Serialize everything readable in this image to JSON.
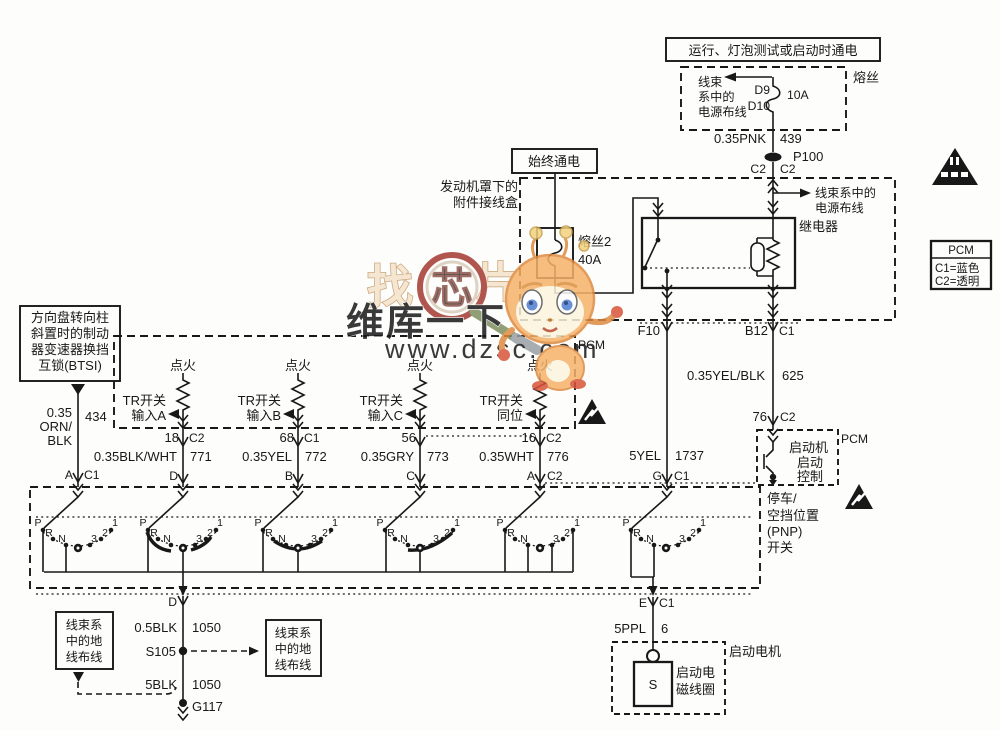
{
  "watermark": {
    "char1": "找",
    "char2": "芯",
    "char3": "片",
    "tagline": "维库一下",
    "url": "www.dzsc.com"
  },
  "top_power": {
    "title": "运行、灯泡测试或启动时通电",
    "fuse_name": "熔丝",
    "harness_l1": "线束",
    "harness_l2": "系中的",
    "harness_l3": "电源布线",
    "term_top": "D9",
    "term_bottom": "D10",
    "rating": "10A",
    "wire": "0.35PNK",
    "circuit": "439",
    "splice": "P100",
    "conn_left": "C2",
    "conn_right": "C2"
  },
  "junction_box": {
    "always_on": "始终通电",
    "name_l1": "发动机罩下的",
    "name_l2": "附件接线盒",
    "fuse2_name": "熔丝2",
    "fuse2_rating": "40A",
    "harness_l1": "线束系中的",
    "harness_l2": "电源布线",
    "relay": "继电器",
    "out_left": "F10",
    "out_right": "B12",
    "out_right_conn": "C1"
  },
  "start_control": {
    "wire": "0.35YEL/BLK",
    "circuit": "625",
    "term": "76",
    "conn": "C2",
    "pcm": "PCM",
    "l1": "启动机",
    "l2": "启动",
    "l3": "控制"
  },
  "crank_wire": {
    "wire": "5YEL",
    "circuit": "1737",
    "term": "G",
    "conn": "C1"
  },
  "btsi": {
    "l1": "方向盘转向柱",
    "l2": "斜置时的制动",
    "l3": "器变速器换挡",
    "l4": "互锁(BTSI)",
    "wire_l1": "0.35",
    "wire_l2": "ORN/",
    "wire_l3": "BLK",
    "circuit": "434",
    "term": "A",
    "conn": "C1"
  },
  "tr_box": {
    "pcm": "PCM",
    "columns": [
      {
        "ign": "点火",
        "label1": "TR开关",
        "label2": "输入A",
        "pin": "18",
        "pin_conn": "C2",
        "wire": "0.35BLK/WHT",
        "circuit": "771",
        "term": "D",
        "term_conn": ""
      },
      {
        "ign": "点火",
        "label1": "TR开关",
        "label2": "输入B",
        "pin": "68",
        "pin_conn": "C1",
        "wire": "0.35YEL",
        "circuit": "772",
        "term": "B",
        "term_conn": ""
      },
      {
        "ign": "点火",
        "label1": "TR开关",
        "label2": "输入C",
        "pin": "56",
        "pin_conn": "",
        "wire": "0.35GRY",
        "circuit": "773",
        "term": "C",
        "term_conn": ""
      },
      {
        "ign": "点火",
        "label1": "TR开关",
        "label2": "同位",
        "pin": "16",
        "pin_conn": "C2",
        "wire": "0.35WHT",
        "circuit": "776",
        "term": "A",
        "term_conn": "C2"
      }
    ]
  },
  "pnp_switch": {
    "positions": [
      "P",
      "R",
      "N",
      "3",
      "2",
      "1"
    ],
    "label_l1": "停车/",
    "label_l2": "空挡位置",
    "label_l3": "(PNP)",
    "label_l4": "开关"
  },
  "ground_path": {
    "term": "D",
    "wire1": "0.5BLK",
    "circuit1": "1050",
    "splice": "S105",
    "wire2": "5BLK",
    "circuit2": "1050",
    "ground": "G117",
    "box_l1": "线束系",
    "box_l2": "中的地",
    "box_l3": "线布线"
  },
  "starter": {
    "term": "E",
    "conn": "C1",
    "wire": "5PPL",
    "circuit": "6",
    "solenoid": "S",
    "sol_l1": "启动电",
    "sol_l2": "磁线圈",
    "motor": "启动电机"
  },
  "legend": {
    "title": "PCM",
    "row1": "C1=蓝色",
    "row2": "C2=透明"
  }
}
